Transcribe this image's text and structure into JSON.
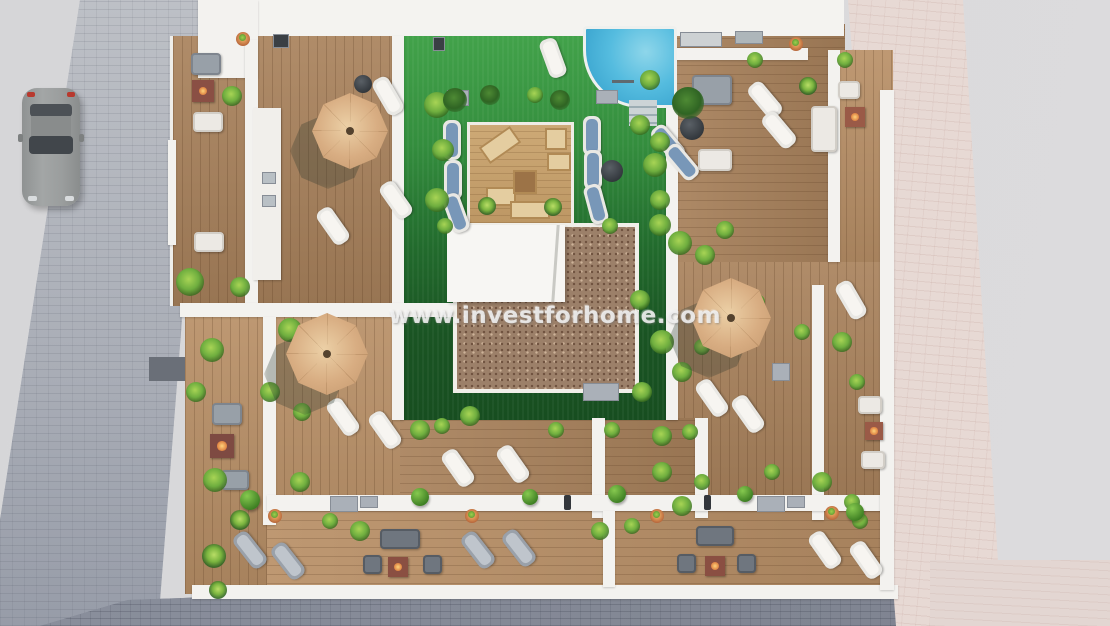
{
  "watermark": {
    "text": "www.investforhome.com"
  },
  "palette": {
    "road_gray": "#d7d7d9",
    "sidewalk_light": "#b4b7be",
    "sidewalk_dark": "#828794",
    "sidewalk_pink": "#e7d9d4",
    "deck_wood": "#a9825c",
    "platform_wood": "#c4a06c",
    "lawn_top": "#42a24a",
    "lawn_bottom": "#174e20",
    "pool_water": "#55bcdf",
    "gravel_brown": "#9c8069",
    "wall_white": "#f3f2ef",
    "umbrella_tan": "#d8ad82",
    "fire_table_red": "#8a4f42",
    "plant_green": "#6fae3f",
    "car_gray": "#9a9d9d"
  },
  "scene": {
    "type": "aerial-3d-render",
    "features": [
      "rooftop terraces",
      "swimming pool with steps",
      "central sun-deck platform",
      "lawn courtyard",
      "tan parasols",
      "sun loungers",
      "outdoor sofa sets",
      "fire pit tables",
      "planters and topiary",
      "parked car on street",
      "paved sidewalks"
    ]
  }
}
